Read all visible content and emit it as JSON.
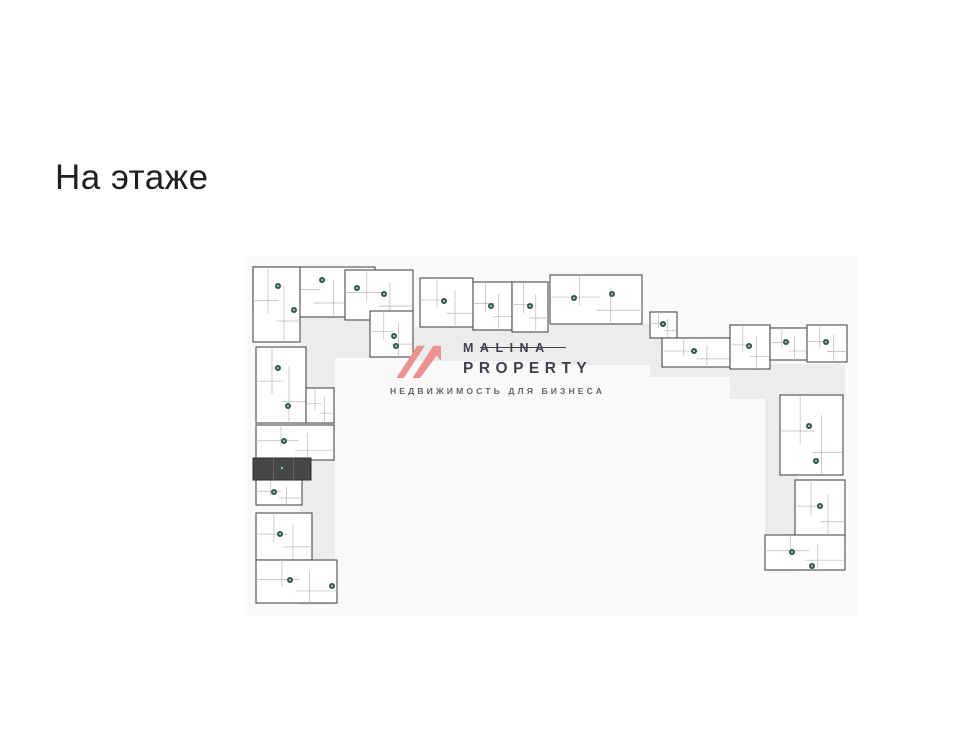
{
  "page": {
    "title": "На этаже"
  },
  "watermark": {
    "brand_line1": "MALINA",
    "brand_line2": "PROPERTY",
    "tagline": "НЕДВИЖИМОСТЬ ДЛЯ БИЗНЕСА",
    "icon_color": "#eb9191",
    "text_color": "#3d4449",
    "tagline_color": "#5f666c"
  },
  "plan": {
    "background": "#fafafa",
    "corridor_color": "#ececec",
    "wall_color": "#4b4b4b",
    "room_line_color": "#b9b9b9",
    "highlight_color": "#474747",
    "highlight_stroke": "#2f2f2f",
    "marker_color": "#2d5b43",
    "width": 614,
    "height": 360,
    "corridors": [
      [
        56,
        61,
        35,
        288
      ],
      [
        56,
        61,
        113,
        41
      ],
      [
        169,
        71,
        137,
        34
      ],
      [
        306,
        68,
        112,
        41
      ],
      [
        406,
        81,
        92,
        40
      ],
      [
        486,
        108,
        115,
        35
      ],
      [
        521,
        139,
        32,
        176
      ]
    ],
    "blocks": [
      [
        9,
        11,
        122,
        50
      ],
      [
        9,
        11,
        47,
        75
      ],
      [
        101,
        14,
        68,
        50
      ],
      [
        126,
        55,
        43,
        46
      ],
      [
        176,
        22,
        53,
        49
      ],
      [
        229,
        26,
        39,
        48
      ],
      [
        268,
        26,
        36,
        50
      ],
      [
        306,
        19,
        92,
        49
      ],
      [
        406,
        56,
        27,
        26
      ],
      [
        418,
        82,
        68,
        29
      ],
      [
        486,
        69,
        40,
        44
      ],
      [
        526,
        72,
        37,
        32
      ],
      [
        563,
        69,
        40,
        37
      ],
      [
        536,
        139,
        63,
        80
      ],
      [
        551,
        224,
        50,
        58
      ],
      [
        521,
        279,
        80,
        35
      ],
      [
        12,
        91,
        50,
        76
      ],
      [
        62,
        132,
        28,
        35
      ],
      [
        12,
        169,
        78,
        35
      ],
      [
        12,
        224,
        46,
        25
      ],
      [
        12,
        257,
        56,
        47
      ],
      [
        12,
        304,
        81,
        43
      ]
    ],
    "dark_unit": [
      9,
      202,
      58,
      22
    ],
    "markers": [
      [
        34,
        30
      ],
      [
        78,
        24
      ],
      [
        113,
        32
      ],
      [
        50,
        54
      ],
      [
        140,
        38
      ],
      [
        150,
        80
      ],
      [
        200,
        45
      ],
      [
        247,
        50
      ],
      [
        286,
        50
      ],
      [
        330,
        42
      ],
      [
        368,
        38
      ],
      [
        419,
        68
      ],
      [
        450,
        95
      ],
      [
        505,
        90
      ],
      [
        542,
        86
      ],
      [
        582,
        86
      ],
      [
        565,
        170
      ],
      [
        572,
        205
      ],
      [
        576,
        250
      ],
      [
        548,
        296
      ],
      [
        568,
        310
      ],
      [
        34,
        112
      ],
      [
        44,
        150
      ],
      [
        40,
        185
      ],
      [
        38,
        212
      ],
      [
        30,
        236
      ],
      [
        36,
        278
      ],
      [
        46,
        324
      ],
      [
        88,
        330
      ],
      [
        152,
        90
      ]
    ]
  }
}
